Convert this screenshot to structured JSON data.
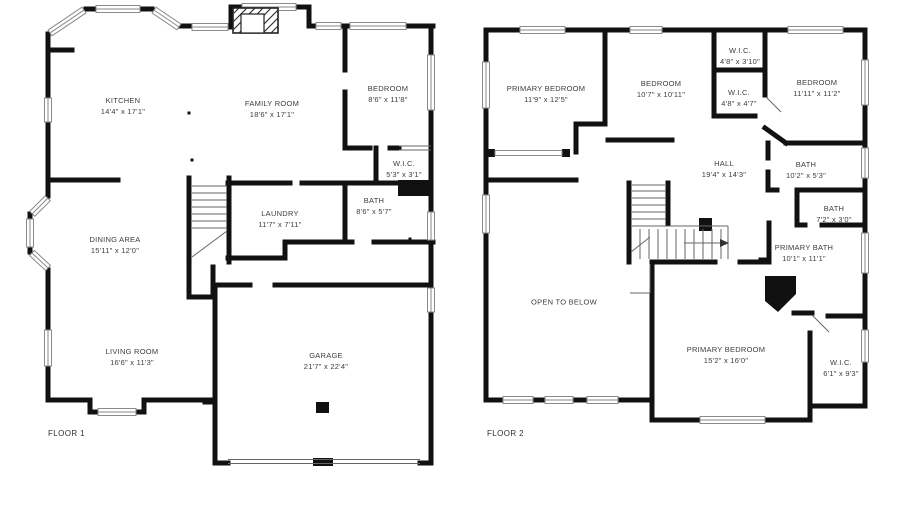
{
  "title": "Two-story house floor plan",
  "colors": {
    "wall": "#111111",
    "window_outline": "#8a8a8a",
    "label_text": "#3d3d3d",
    "background": "#ffffff"
  },
  "floors": [
    {
      "label": "FLOOR 1",
      "caption_pos": {
        "x": 48,
        "y": 429
      },
      "rooms": [
        {
          "name": "KITCHEN",
          "dims": "14'4\" x 17'1\"",
          "x": 123,
          "y": 106
        },
        {
          "name": "FAMILY ROOM",
          "dims": "18'6\" x 17'1\"",
          "x": 272,
          "y": 109
        },
        {
          "name": "BEDROOM",
          "dims": "8'6\" x 11'8\"",
          "x": 388,
          "y": 94
        },
        {
          "name": "W.I.C.",
          "dims": "5'3\" x 3'1\"",
          "x": 404,
          "y": 169
        },
        {
          "name": "BATH",
          "dims": "8'6\" x 5'7\"",
          "x": 374,
          "y": 206
        },
        {
          "name": "LAUNDRY",
          "dims": "11'7\" x 7'11\"",
          "x": 280,
          "y": 219
        },
        {
          "name": "DINING AREA",
          "dims": "15'11\" x 12'0\"",
          "x": 115,
          "y": 245
        },
        {
          "name": "LIVING ROOM",
          "dims": "16'6\" x 11'3\"",
          "x": 132,
          "y": 357
        },
        {
          "name": "GARAGE",
          "dims": "21'7\" x 22'4\"",
          "x": 326,
          "y": 361
        }
      ]
    },
    {
      "label": "FLOOR 2",
      "caption_pos": {
        "x": 487,
        "y": 429
      },
      "rooms": [
        {
          "name": "PRIMARY BEDROOM",
          "dims": "11'9\" x 12'5\"",
          "x": 546,
          "y": 94
        },
        {
          "name": "BEDROOM",
          "dims": "10'7\" x 10'11\"",
          "x": 661,
          "y": 89
        },
        {
          "name": "W.I.C.",
          "dims": "4'8\" x 3'10\"",
          "x": 740,
          "y": 56
        },
        {
          "name": "W.I.C.",
          "dims": "4'8\" x 4'7\"",
          "x": 739,
          "y": 98
        },
        {
          "name": "BEDROOM",
          "dims": "11'11\" x 11'2\"",
          "x": 817,
          "y": 88
        },
        {
          "name": "HALL",
          "dims": "19'4\" x 14'3\"",
          "x": 724,
          "y": 169
        },
        {
          "name": "BATH",
          "dims": "10'2\" x 5'3\"",
          "x": 806,
          "y": 170
        },
        {
          "name": "BATH",
          "dims": "7'2\" x 3'0\"",
          "x": 834,
          "y": 214
        },
        {
          "name": "PRIMARY BATH",
          "dims": "10'1\" x 11'1\"",
          "x": 804,
          "y": 253
        },
        {
          "name": "OPEN TO BELOW",
          "dims": "",
          "x": 564,
          "y": 302
        },
        {
          "name": "PRIMARY BEDROOM",
          "dims": "15'2\" x 16'0\"",
          "x": 726,
          "y": 355
        },
        {
          "name": "W.I.C.",
          "dims": "6'1\" x 9'3\"",
          "x": 841,
          "y": 368
        }
      ]
    }
  ]
}
